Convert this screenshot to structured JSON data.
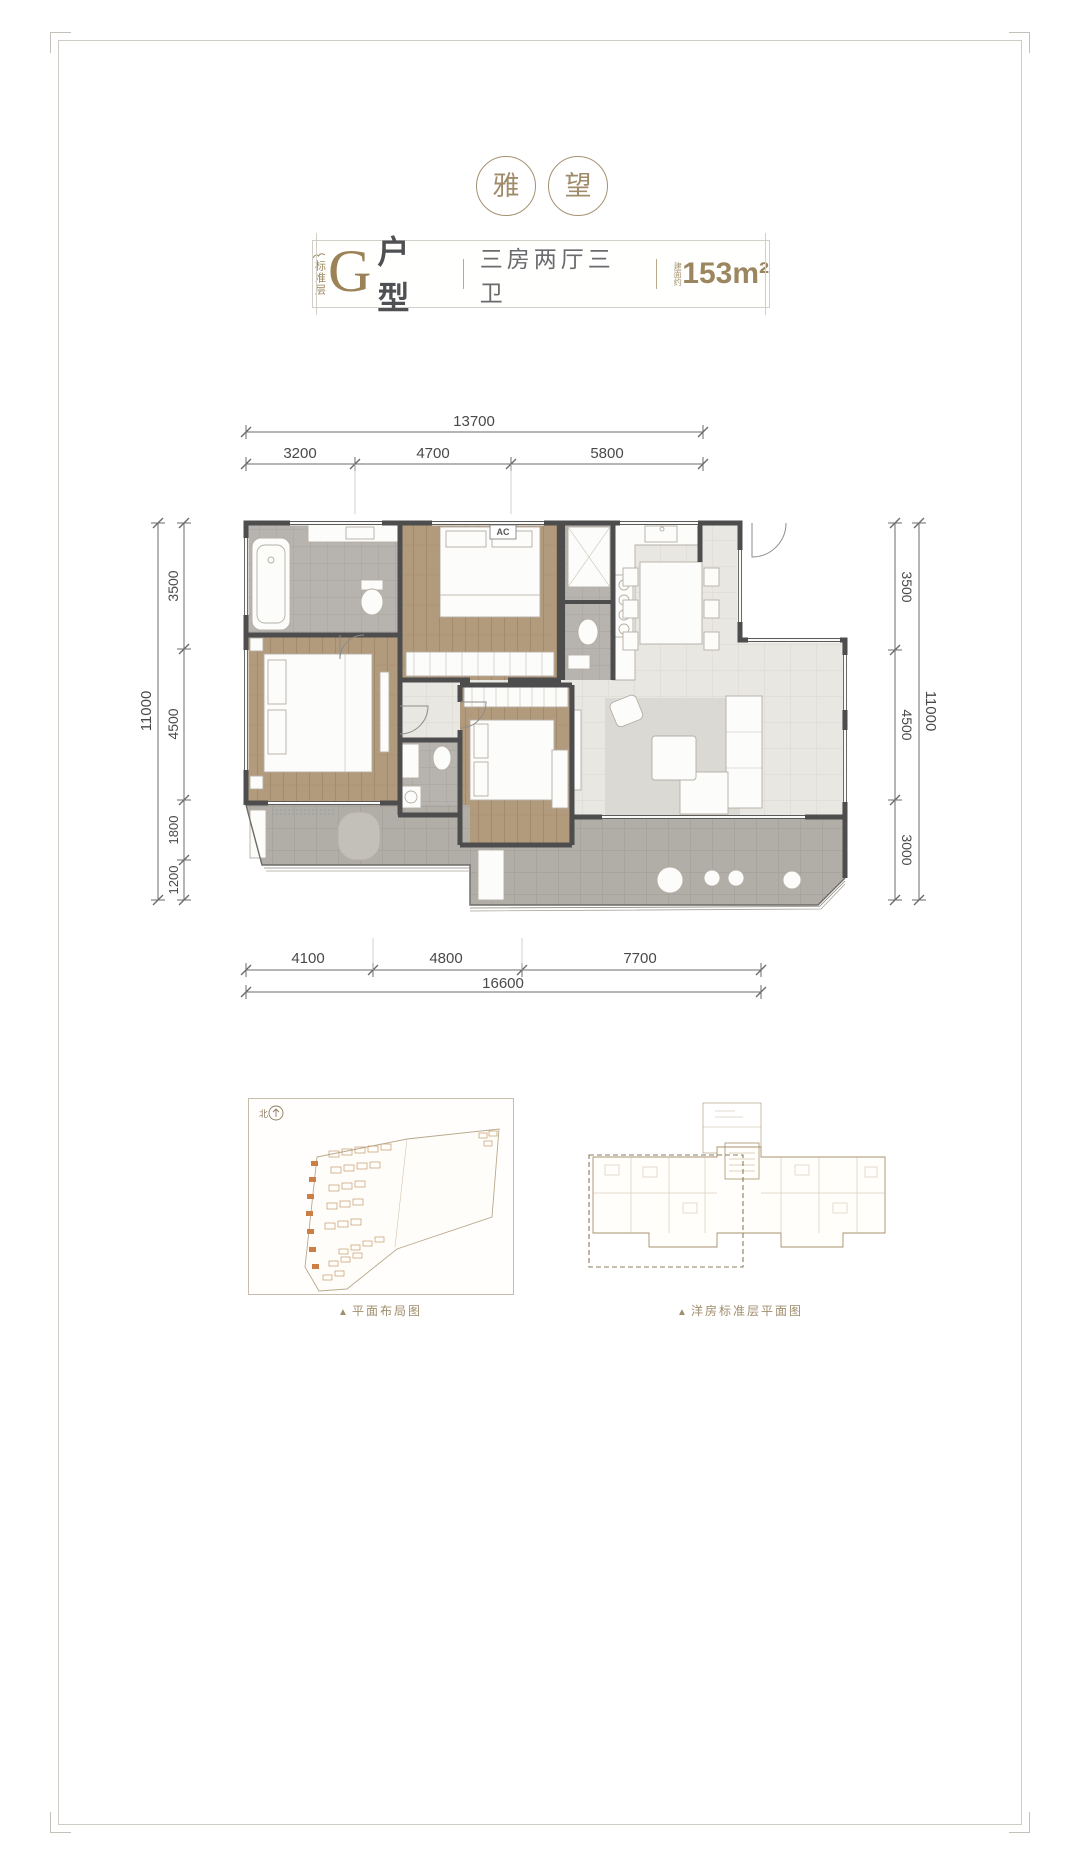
{
  "logo": {
    "char_left": "雅",
    "char_right": "望"
  },
  "title_card": {
    "floor_label": "标准层",
    "unit_letter": "G",
    "unit_type_label": "户型",
    "layout_text": "三房两厅三卫",
    "area_prefix": "建面约",
    "area_value": "153m²"
  },
  "floor_plan": {
    "ac_label": "AC",
    "dimensions": {
      "top_total": "13700",
      "top_segments": [
        "3200",
        "4700",
        "5800"
      ],
      "left_total": "11000",
      "left_segments": [
        "3500",
        "4500",
        "1800",
        "1200"
      ],
      "right_total": "11000",
      "right_segments": [
        "3500",
        "4500",
        "3000"
      ],
      "bottom_segments": [
        "4100",
        "4800",
        "7700"
      ],
      "bottom_total": "16600"
    }
  },
  "site_plan": {
    "north_label": "北",
    "caption_icon": "▲",
    "caption": "平面布局图"
  },
  "key_plan": {
    "caption_icon": "▲",
    "caption": "洋房标准层平面图"
  },
  "colors": {
    "gold": "#9b8860",
    "dark_text": "#4f5053",
    "wall": "#4d4d4d",
    "wood": "#b29a7d",
    "tile_light": "#e9e7e2",
    "tile_gray": "#b7b3ae"
  }
}
